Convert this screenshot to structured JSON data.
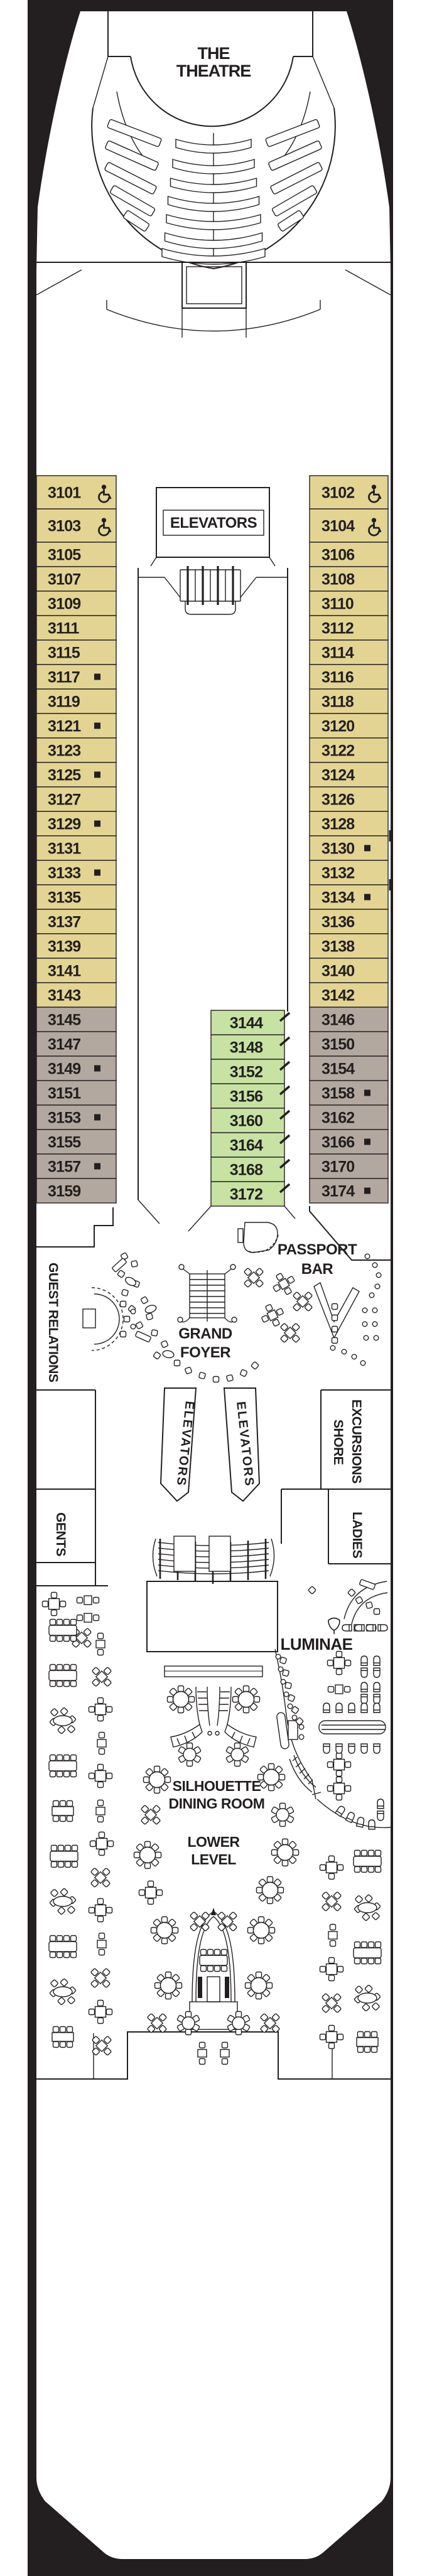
{
  "labels": {
    "theatre": [
      "THE",
      "THEATRE"
    ],
    "elevators_lobby": "ELEVATORS",
    "elevators_left": "ELEVATORS",
    "elevators_right": "ELEVATORS",
    "guest_relations": "GUEST RELATIONS",
    "passport_bar": [
      "PASSPORT",
      "BAR"
    ],
    "grand_foyer": [
      "GRAND",
      "FOYER"
    ],
    "shore_excursions": [
      "SHORE",
      "EXCURSIONS"
    ],
    "gents": "GENTS",
    "ladies": "LADIES",
    "luminae": "LUMINAE",
    "dining_room": [
      "SILHOUETTE",
      "DINING ROOM"
    ],
    "lower_level": [
      "LOWER",
      "LEVEL"
    ]
  },
  "colors": {
    "ink": "#231f20",
    "tan": "#e3d493",
    "gray": "#b2a89f",
    "green": "#c7e2a2"
  },
  "icons": {
    "accessible": "wheelchair-accessible-icon",
    "square": "obstructed-view-square-icon",
    "diagonal": "connecting-stateroom-tick-icon"
  },
  "cabins": {
    "left": [
      {
        "n": "3101",
        "c": "tan",
        "acc": true
      },
      {
        "n": "3103",
        "c": "tan",
        "acc": true
      },
      {
        "n": "3105",
        "c": "tan"
      },
      {
        "n": "3107",
        "c": "tan"
      },
      {
        "n": "3109",
        "c": "tan"
      },
      {
        "n": "3111",
        "c": "tan"
      },
      {
        "n": "3115",
        "c": "tan"
      },
      {
        "n": "3117",
        "c": "tan",
        "sq": true
      },
      {
        "n": "3119",
        "c": "tan"
      },
      {
        "n": "3121",
        "c": "tan",
        "sq": true
      },
      {
        "n": "3123",
        "c": "tan"
      },
      {
        "n": "3125",
        "c": "tan",
        "sq": true
      },
      {
        "n": "3127",
        "c": "tan"
      },
      {
        "n": "3129",
        "c": "tan",
        "sq": true,
        "tick": true
      },
      {
        "n": "3131",
        "c": "tan"
      },
      {
        "n": "3133",
        "c": "tan",
        "sq": true,
        "tick": true
      },
      {
        "n": "3135",
        "c": "tan"
      },
      {
        "n": "3137",
        "c": "tan"
      },
      {
        "n": "3139",
        "c": "tan"
      },
      {
        "n": "3141",
        "c": "tan"
      },
      {
        "n": "3143",
        "c": "tan"
      },
      {
        "n": "3145",
        "c": "gray"
      },
      {
        "n": "3147",
        "c": "gray"
      },
      {
        "n": "3149",
        "c": "gray",
        "sq": true
      },
      {
        "n": "3151",
        "c": "gray"
      },
      {
        "n": "3153",
        "c": "gray",
        "sq": true
      },
      {
        "n": "3155",
        "c": "gray"
      },
      {
        "n": "3157",
        "c": "gray",
        "sq": true
      },
      {
        "n": "3159",
        "c": "gray"
      }
    ],
    "center": [
      {
        "n": "3144",
        "c": "green",
        "conn": true
      },
      {
        "n": "3148",
        "c": "green",
        "conn": true
      },
      {
        "n": "3152",
        "c": "green",
        "conn": true
      },
      {
        "n": "3156",
        "c": "green",
        "conn": true
      },
      {
        "n": "3160",
        "c": "green",
        "conn": true
      },
      {
        "n": "3164",
        "c": "green",
        "conn": true
      },
      {
        "n": "3168",
        "c": "green",
        "conn": true
      },
      {
        "n": "3172",
        "c": "green",
        "conn": true
      }
    ],
    "right": [
      {
        "n": "3102",
        "c": "tan",
        "acc": true
      },
      {
        "n": "3104",
        "c": "tan",
        "acc": true
      },
      {
        "n": "3106",
        "c": "tan"
      },
      {
        "n": "3108",
        "c": "tan"
      },
      {
        "n": "3110",
        "c": "tan"
      },
      {
        "n": "3112",
        "c": "tan"
      },
      {
        "n": "3114",
        "c": "tan"
      },
      {
        "n": "3116",
        "c": "tan"
      },
      {
        "n": "3118",
        "c": "tan"
      },
      {
        "n": "3120",
        "c": "tan"
      },
      {
        "n": "3122",
        "c": "tan"
      },
      {
        "n": "3124",
        "c": "tan"
      },
      {
        "n": "3126",
        "c": "tan"
      },
      {
        "n": "3128",
        "c": "tan",
        "tick": true
      },
      {
        "n": "3130",
        "c": "tan",
        "sq": true
      },
      {
        "n": "3132",
        "c": "tan",
        "tick": true
      },
      {
        "n": "3134",
        "c": "tan",
        "sq": true
      },
      {
        "n": "3136",
        "c": "tan"
      },
      {
        "n": "3138",
        "c": "tan"
      },
      {
        "n": "3140",
        "c": "tan"
      },
      {
        "n": "3142",
        "c": "tan"
      },
      {
        "n": "3146",
        "c": "gray"
      },
      {
        "n": "3150",
        "c": "gray"
      },
      {
        "n": "3154",
        "c": "gray"
      },
      {
        "n": "3158",
        "c": "gray",
        "sq": true
      },
      {
        "n": "3162",
        "c": "gray"
      },
      {
        "n": "3166",
        "c": "gray",
        "sq": true
      },
      {
        "n": "3170",
        "c": "gray"
      },
      {
        "n": "3174",
        "c": "gray",
        "sq": true
      }
    ]
  }
}
